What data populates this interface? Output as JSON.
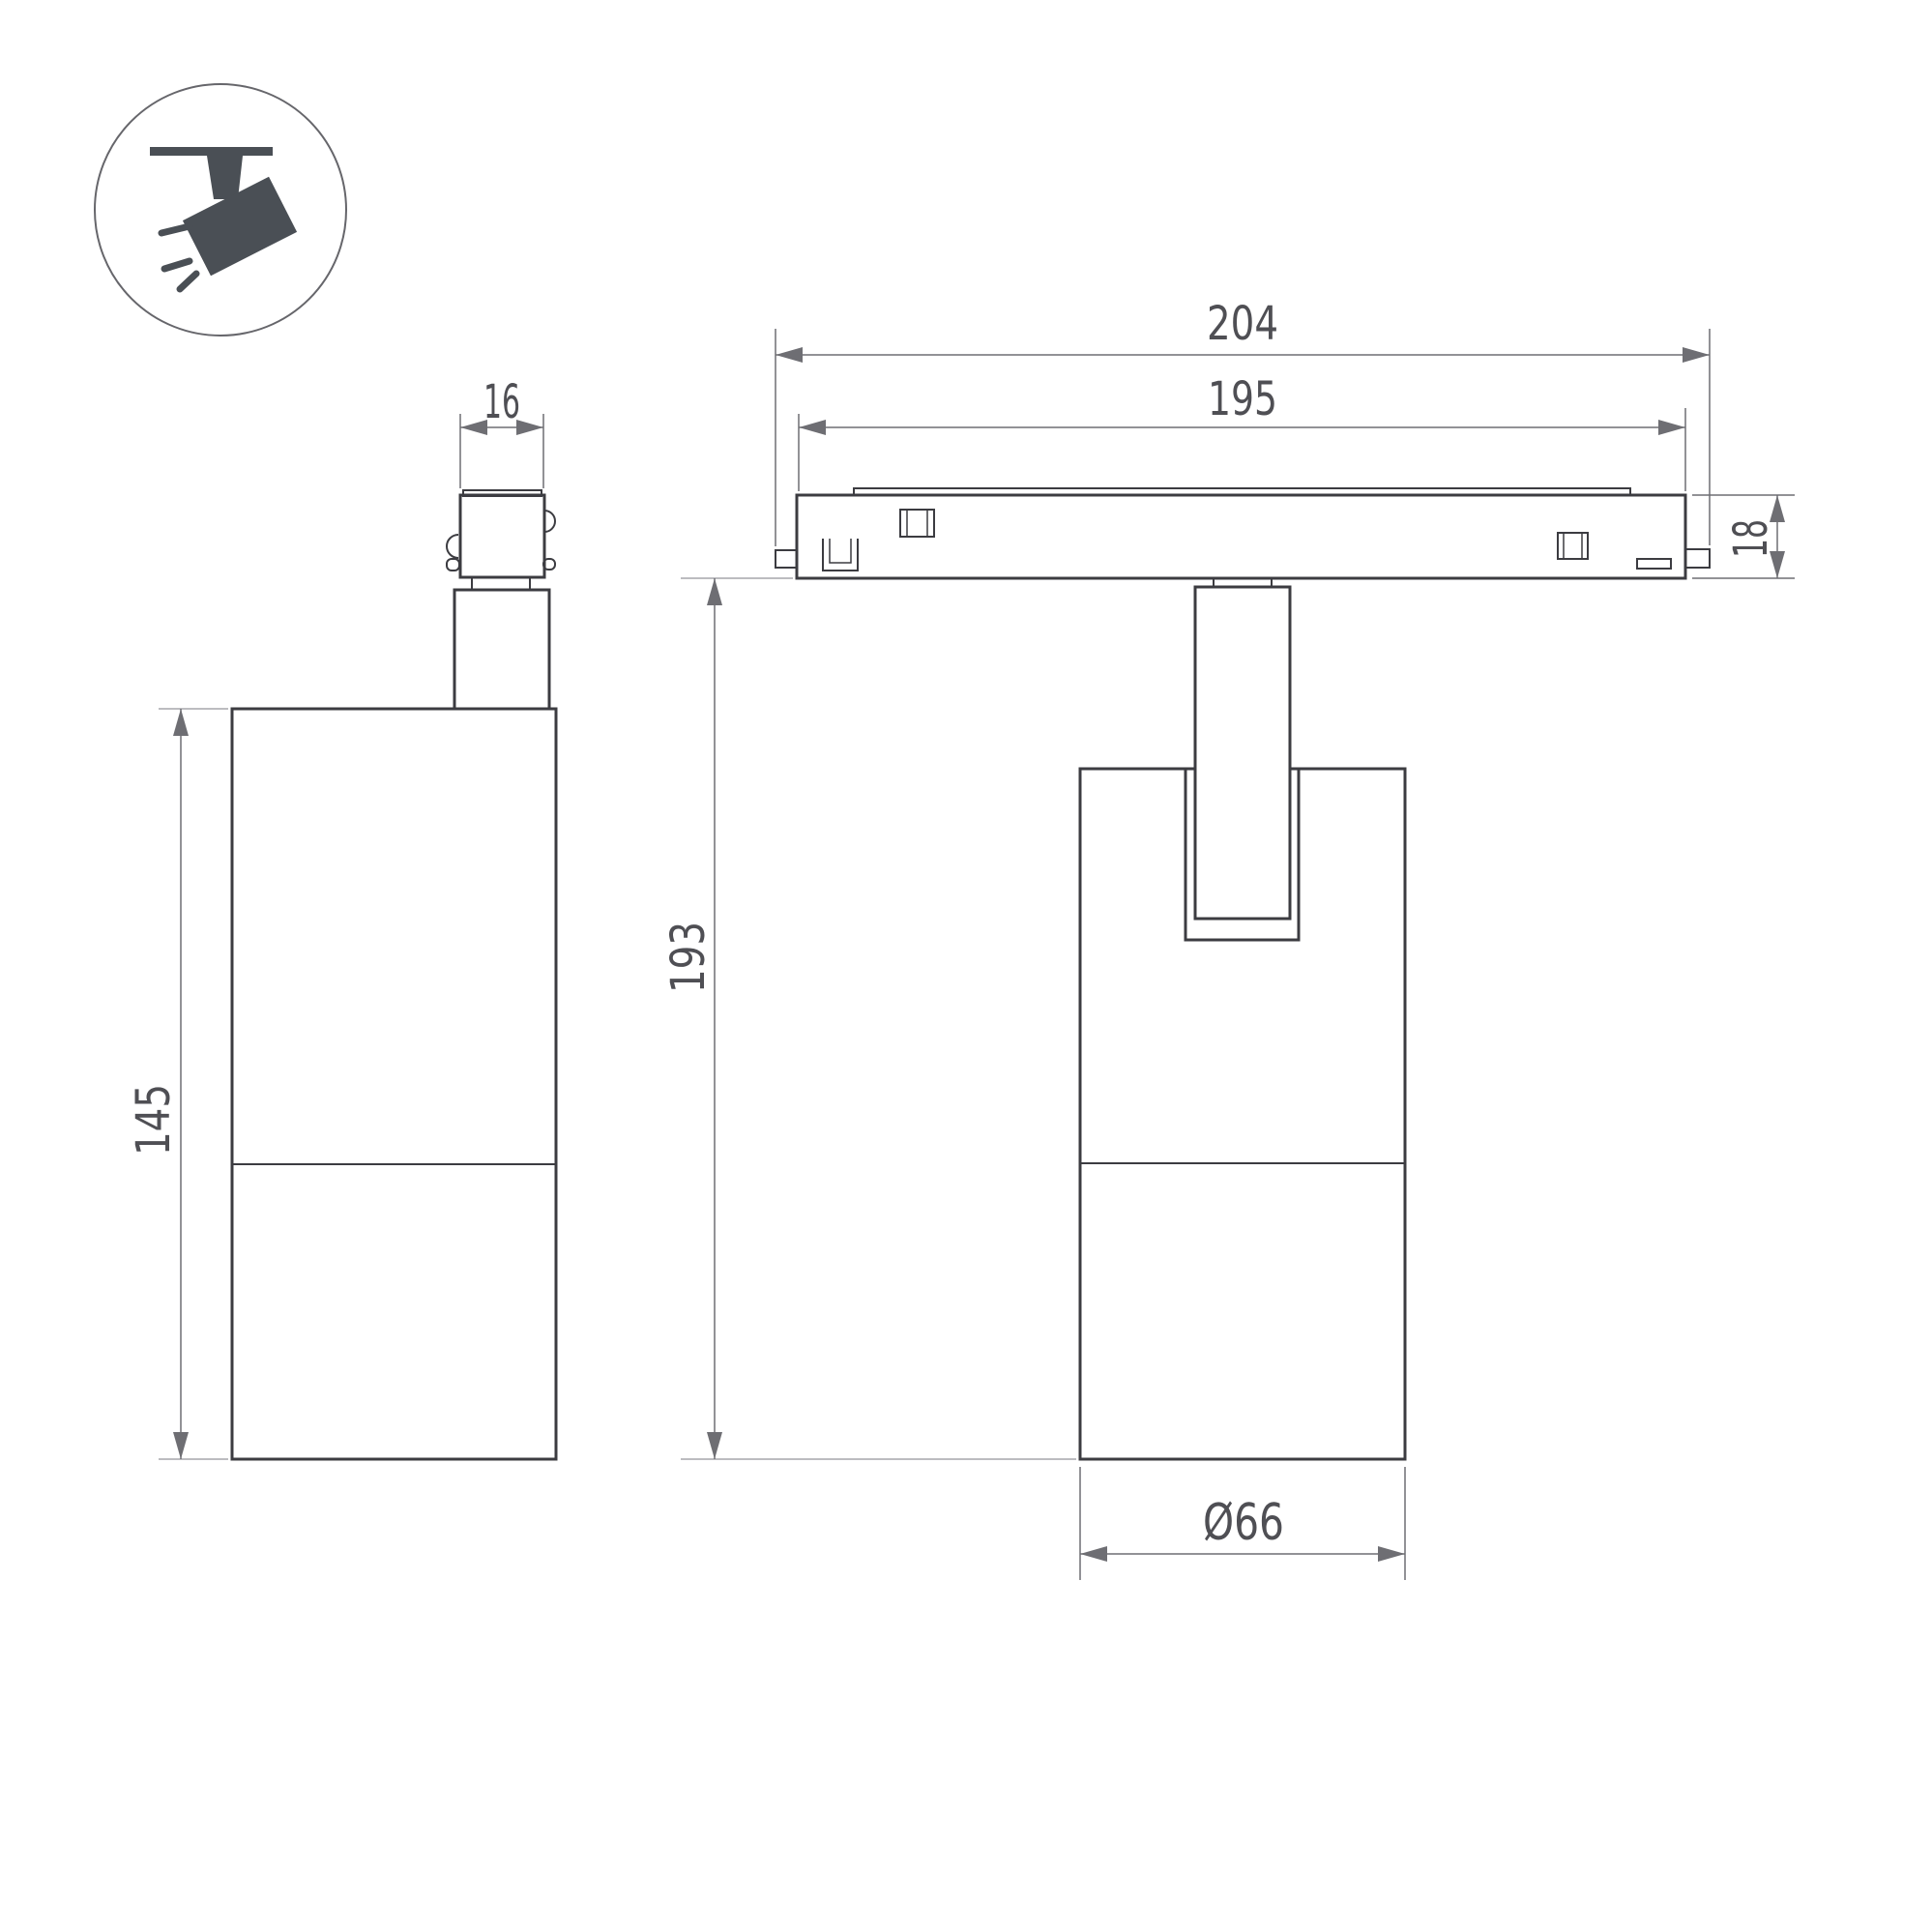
{
  "icons": {
    "legend": "track-spotlight-icon"
  },
  "colors": {
    "outline": "#3c3c41",
    "dimension_line": "#6e6e73",
    "extension_line": "#a6a6ab",
    "text": "#4f4f54",
    "icon": "#4a4f55",
    "background": "#ffffff"
  },
  "dimensions": {
    "track_full_length": "204",
    "track_body_length": "195",
    "track_height": "18",
    "adapter_width": "16",
    "lamp_body_height": "145",
    "overall_height": "193",
    "lamp_body_diameter": "Ø66"
  }
}
